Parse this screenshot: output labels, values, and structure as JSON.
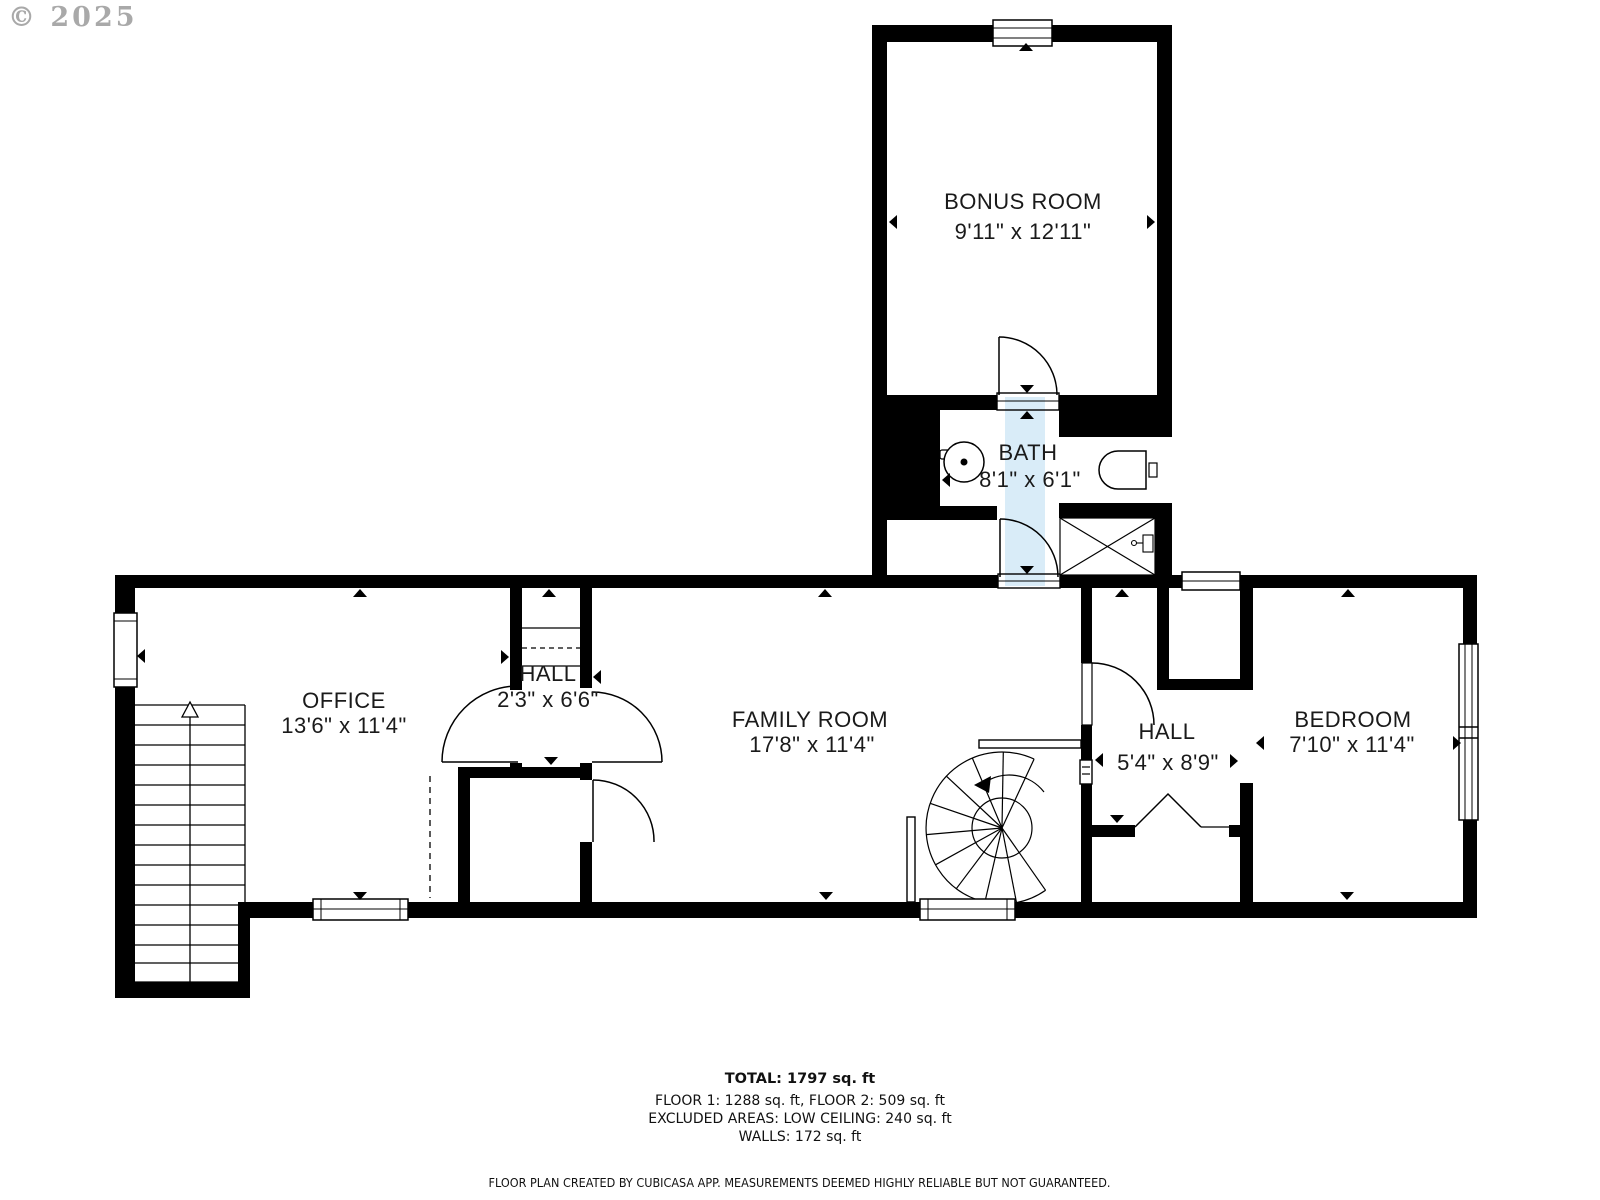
{
  "watermark": "© 2025",
  "rooms": [
    {
      "name": "BONUS ROOM",
      "dimensions": "9'11\" x 12'11\""
    },
    {
      "name": "BATH",
      "dimensions": "8'1\" x 6'1\""
    },
    {
      "name": "OFFICE",
      "dimensions": "13'6\" x 11'4\""
    },
    {
      "name": "HALL",
      "dimensions": "2'3\" x 6'6\""
    },
    {
      "name": "FAMILY ROOM",
      "dimensions": "17'8\" x 11'4\""
    },
    {
      "name": "HALL",
      "dimensions": "5'4\" x 8'9\""
    },
    {
      "name": "BEDROOM",
      "dimensions": "7'10\" x 11'4\""
    }
  ],
  "summary": {
    "total": "TOTAL: 1797 sq. ft",
    "floors": "FLOOR 1: 1288 sq. ft, FLOOR 2: 509 sq. ft",
    "excluded": "EXCLUDED AREAS: LOW CEILING: 240 sq. ft",
    "walls": "WALLS: 172 sq. ft"
  },
  "footer": "FLOOR PLAN CREATED BY CUBICASA APP. MEASUREMENTS DEEMED HIGHLY RELIABLE BUT NOT GUARANTEED.",
  "colors": {
    "wall": "#000000",
    "low_ceiling_overlay": "#d9ecf8",
    "watermark": "#9b9b9b",
    "label_text": "#1a1a1a"
  }
}
